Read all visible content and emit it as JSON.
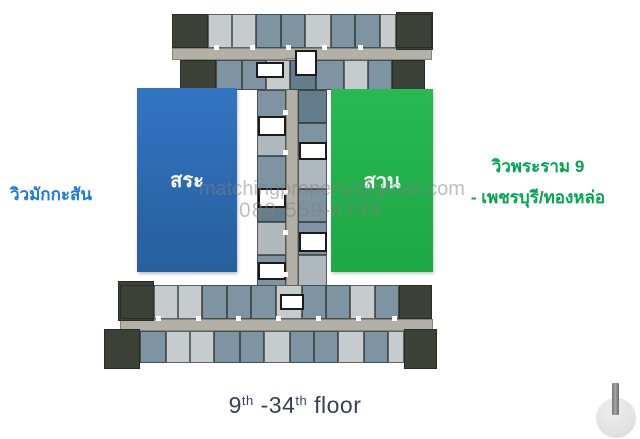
{
  "labels": {
    "left_view": "วิวมักกะสัน",
    "pool": "สระ",
    "garden": "สวน",
    "right_view_line1": "วิวพระราม 9",
    "right_view_line2": "- เพชรบุรี/ทองหล่อ",
    "floor_range": {
      "num1": "9",
      "sup1": "th",
      "mid": " -34",
      "sup2": "th",
      "suffix": " floor"
    }
  },
  "watermark": {
    "email": "matchingproperty@gmail.com",
    "phone": "089-559-8744"
  },
  "colors": {
    "pool_blue": "#2d6db6",
    "garden_green": "#23b24e",
    "left_label_blue": "#1d7bd9",
    "right_label_green": "#00a550",
    "floor_label_navy": "#36415a",
    "watermark_gray": "#8a8a8a",
    "plan_dark_unit": "#3c4138",
    "plan_slate_unit": "#7e94a2",
    "plan_light_unit": "#c6cbce",
    "plan_corridor": "#b3b0a7"
  },
  "icons": {
    "bottom_right": "pushpin-icon"
  },
  "floorplan": {
    "palette": {
      "D": "#3c4138",
      "M": "#7e94a2",
      "M2": "#647d8c",
      "L": "#c6cbce",
      "L2": "#aeb8bd",
      "C": "#b3b0a7",
      "W": "#ffffff"
    },
    "shapes": [
      {
        "x": 172,
        "y": 48,
        "w": 260,
        "h": 12,
        "c": "C",
        "cls": "corr",
        "n": "corridor-top"
      },
      {
        "x": 286,
        "y": 58,
        "w": 12,
        "h": 262,
        "c": "C",
        "cls": "corr",
        "n": "corridor-core"
      },
      {
        "x": 120,
        "y": 319,
        "w": 313,
        "h": 12,
        "c": "C",
        "cls": "corr",
        "n": "corridor-bottom"
      },
      {
        "x": 118,
        "y": 281,
        "w": 36,
        "h": 40,
        "c": "D",
        "cls": "cell",
        "n": "dark-end-unit"
      },
      {
        "x": 396,
        "y": 12,
        "w": 37,
        "h": 38,
        "c": "D",
        "cls": "cell",
        "n": "dark-end-unit"
      },
      {
        "x": 172,
        "y": 14,
        "h": 34,
        "n": "top-wing-row-a",
        "cells": [
          [
            36,
            "D"
          ],
          [
            24,
            "L"
          ],
          [
            24,
            "L"
          ],
          [
            25,
            "M"
          ],
          [
            24,
            "M"
          ],
          [
            26,
            "L"
          ],
          [
            24,
            "M"
          ],
          [
            25,
            "M"
          ],
          [
            16,
            "L"
          ],
          [
            36,
            "D"
          ]
        ]
      },
      {
        "x": 180,
        "y": 60,
        "h": 30,
        "n": "top-wing-row-b",
        "cells": [
          [
            36,
            "D"
          ],
          [
            26,
            "M"
          ],
          [
            24,
            "M"
          ],
          [
            24,
            "L"
          ],
          [
            26,
            "M2"
          ],
          [
            28,
            "M"
          ],
          [
            24,
            "L"
          ],
          [
            24,
            "M"
          ],
          [
            33,
            "D"
          ]
        ]
      },
      {
        "x": 257,
        "y": 90,
        "w": 29,
        "n": "core-left-units",
        "vcells": [
          [
            33,
            "M"
          ],
          [
            33,
            "L2"
          ],
          [
            33,
            "M"
          ],
          [
            33,
            "M2"
          ],
          [
            33,
            "L2"
          ],
          [
            33,
            "M"
          ]
        ]
      },
      {
        "x": 298,
        "y": 90,
        "w": 29,
        "n": "core-right-units",
        "vcells": [
          [
            33,
            "M2"
          ],
          [
            33,
            "M"
          ],
          [
            33,
            "L2"
          ],
          [
            33,
            "M"
          ],
          [
            33,
            "M"
          ],
          [
            33,
            "L2"
          ]
        ]
      },
      {
        "x": 120,
        "y": 285,
        "h": 34,
        "n": "bottom-wing-row-a",
        "cells": [
          [
            34,
            "D"
          ],
          [
            24,
            "L"
          ],
          [
            24,
            "L"
          ],
          [
            25,
            "M"
          ],
          [
            24,
            "M"
          ],
          [
            25,
            "M"
          ],
          [
            26,
            "L"
          ],
          [
            24,
            "M"
          ],
          [
            24,
            "M"
          ],
          [
            25,
            "L"
          ],
          [
            24,
            "M"
          ],
          [
            33,
            "D"
          ]
        ]
      },
      {
        "x": 104,
        "y": 331,
        "h": 32,
        "n": "bottom-wing-row-b",
        "cells": [
          [
            36,
            "D"
          ],
          [
            26,
            "M"
          ],
          [
            24,
            "L"
          ],
          [
            24,
            "L"
          ],
          [
            26,
            "M"
          ],
          [
            24,
            "M"
          ],
          [
            26,
            "L"
          ],
          [
            24,
            "M"
          ],
          [
            24,
            "M"
          ],
          [
            26,
            "L"
          ],
          [
            24,
            "M"
          ],
          [
            16,
            "L"
          ],
          [
            33,
            "D"
          ]
        ]
      },
      {
        "x": 104,
        "y": 329,
        "w": 36,
        "h": 40,
        "c": "D",
        "cls": "cell",
        "n": "dark-end-unit"
      },
      {
        "x": 404,
        "y": 329,
        "w": 33,
        "h": 40,
        "c": "D",
        "cls": "cell",
        "n": "dark-end-unit"
      },
      {
        "x": 295,
        "y": 50,
        "w": 22,
        "h": 26,
        "c": "W",
        "cls": "wbox",
        "n": "elevator-shaft"
      },
      {
        "x": 256,
        "y": 62,
        "w": 28,
        "h": 16,
        "c": "W",
        "cls": "wbox",
        "n": "elevator-shaft"
      },
      {
        "x": 258,
        "y": 116,
        "w": 28,
        "h": 20,
        "c": "W",
        "cls": "wbox",
        "n": "elevator-shaft"
      },
      {
        "x": 299,
        "y": 142,
        "w": 28,
        "h": 18,
        "c": "W",
        "cls": "wbox",
        "n": "elevator-shaft"
      },
      {
        "x": 258,
        "y": 188,
        "w": 28,
        "h": 20,
        "c": "W",
        "cls": "wbox",
        "n": "elevator-shaft"
      },
      {
        "x": 299,
        "y": 232,
        "w": 28,
        "h": 20,
        "c": "W",
        "cls": "wbox",
        "n": "elevator-shaft"
      },
      {
        "x": 258,
        "y": 262,
        "w": 28,
        "h": 18,
        "c": "W",
        "cls": "wbox",
        "n": "elevator-shaft"
      },
      {
        "x": 280,
        "y": 294,
        "w": 24,
        "h": 16,
        "c": "W",
        "cls": "wbox",
        "n": "elevator-shaft"
      },
      {
        "w": 5,
        "h": 5,
        "n": "door-dot",
        "dots": [
          [
            214,
            45
          ],
          [
            250,
            45
          ],
          [
            286,
            45
          ],
          [
            322,
            45
          ],
          [
            358,
            45
          ],
          [
            156,
            316
          ],
          [
            196,
            316
          ],
          [
            236,
            316
          ],
          [
            276,
            316
          ],
          [
            316,
            316
          ],
          [
            356,
            316
          ],
          [
            392,
            316
          ],
          [
            283,
            110
          ],
          [
            283,
            150
          ],
          [
            283,
            190
          ],
          [
            283,
            230
          ],
          [
            283,
            272
          ]
        ]
      }
    ]
  }
}
